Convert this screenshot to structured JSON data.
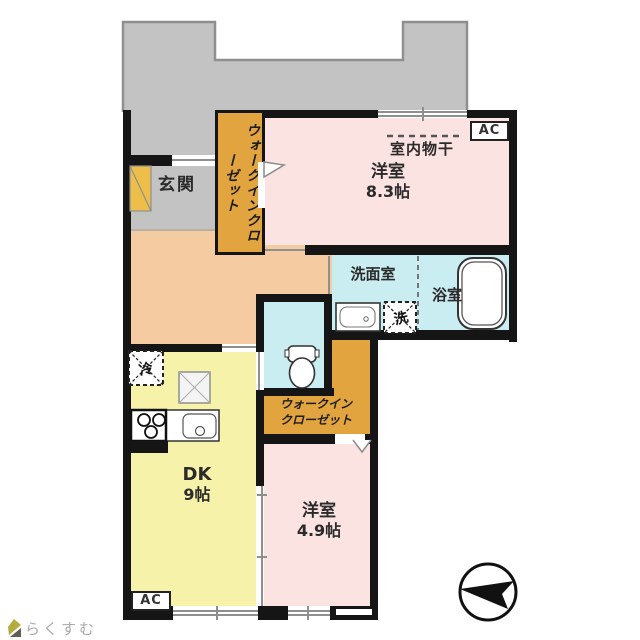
{
  "plan_title": "apartment-floorplan",
  "rooms": {
    "entrance": {
      "label": "玄関"
    },
    "wic1": {
      "line1": "ウォークイン",
      "line2": "クローゼット"
    },
    "bedroom_main": {
      "drying_label": "室内物干",
      "label": "洋室",
      "size": "8.3帖"
    },
    "washroom": {
      "label": "洗面室"
    },
    "bathroom": {
      "label": "浴室"
    },
    "wic2": {
      "line1": "ウォークイン",
      "line2": "クローゼット"
    },
    "dining_kitchen": {
      "label": "DK",
      "size": "9帖"
    },
    "bedroom2": {
      "label": "洋室",
      "size": "4.9帖"
    }
  },
  "fixtures": {
    "refrigerator": "冷",
    "washing_machine": "洗"
  },
  "labels": {
    "ac": "AC"
  },
  "logo": {
    "text": "らくすむ"
  },
  "colors": {
    "wall": "#151515",
    "balcony_gray": "#c3c3c3",
    "hall_peach": "#f5cba1",
    "room_pink": "#fae3e1",
    "wet_cyan": "#c9edf0",
    "closet_orange": "#e2a43f",
    "dk_yellow": "#f7f2aa"
  }
}
